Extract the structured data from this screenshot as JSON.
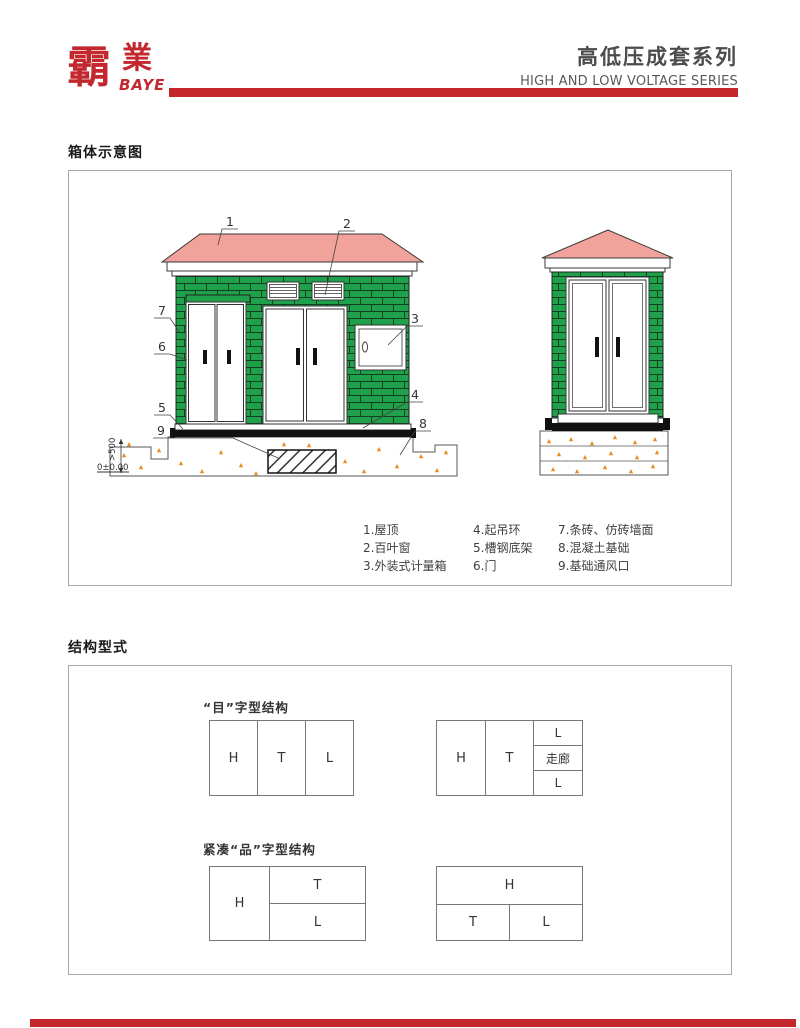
{
  "header": {
    "logo_char1": "霸",
    "logo_char2": "業",
    "logo_sub": "BAYE",
    "title_cn": "高低压成套系列",
    "title_en": "HIGH AND LOW VOLTAGE SERIES"
  },
  "colors": {
    "accent_red": "#c4272b",
    "wall_green": "#1fa04a",
    "roof_pink": "#f0a29b",
    "speckle_orange": "#ee8a22"
  },
  "schematic": {
    "title": "箱体示意图",
    "callouts": [
      "1",
      "2",
      "3",
      "4",
      "5",
      "6",
      "7",
      "8",
      "9"
    ],
    "dim_label": ">500",
    "elevation_label": "0±0.00",
    "legend": {
      "col1": [
        "1.屋顶",
        "2.百叶窗",
        "3.外装式计量箱"
      ],
      "col2": [
        "4.起吊环",
        "5.槽钢底架",
        "6.门"
      ],
      "col3": [
        "7.条砖、仿砖墙面",
        "8.混凝土基础",
        "9.基础通风口"
      ]
    }
  },
  "structure": {
    "title": "结构型式",
    "group1": {
      "label": "“目”字型结构",
      "row_cells": [
        "H",
        "T",
        "L"
      ],
      "corridor": {
        "col1": "H",
        "col2": "T",
        "stack": [
          "L",
          "走廊",
          "L"
        ]
      }
    },
    "group2": {
      "label": "紧凑“品”字型结构",
      "left_stack": {
        "left": "H",
        "rows": [
          "T",
          "L"
        ]
      },
      "top_span": {
        "top": "H",
        "cells": [
          "T",
          "L"
        ]
      }
    }
  }
}
